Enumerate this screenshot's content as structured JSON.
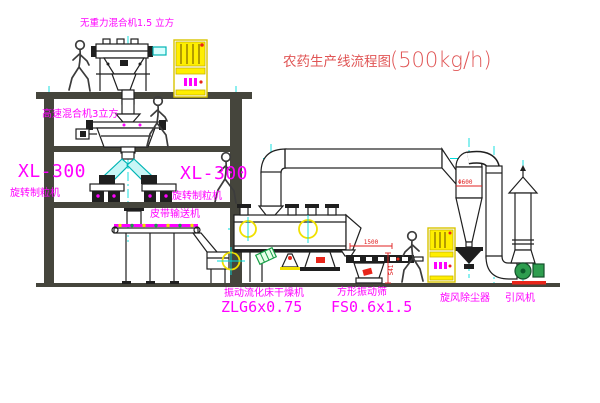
{
  "title": {
    "name": "农药生产线流程图",
    "capacity": "(500kg/h)"
  },
  "labels": {
    "gravity_mixer": "无重力混合机1.5 立方",
    "high_speed_mixer": "高速混合机3立方",
    "granulator_left_model": "XL-300",
    "granulator_left_name": "旋转制粒机",
    "granulator_right_model": "XL-300",
    "granulator_right_name": "旋转制粒机",
    "belt_conveyor": "皮带输送机",
    "dryer_name": "振动流化床干燥机",
    "dryer_model": "ZLG6x0.75",
    "sieve_name": "方形振动筛",
    "sieve_model": "FS0.6x1.5",
    "cyclone_name": "旋风除尘器",
    "fan_name": "引风机"
  },
  "dimensions": {
    "sieve_length": "1500",
    "sieve_height": "541",
    "cyclone_marking": "Φ600"
  },
  "colors": {
    "label": "#ff00ff",
    "title": "#e05555",
    "structure": "#45453c",
    "centerline": "#00dcdc",
    "cabinet": "#ffee00",
    "dimension": "#e02020",
    "fan": "#2e9e4f",
    "equip": "#1f1f1f"
  },
  "icons": {
    "cabinet_display": "magenta-indicator-bars",
    "alignment_target": "crosshair-target",
    "person_figure": "walking-person-silhouette"
  }
}
